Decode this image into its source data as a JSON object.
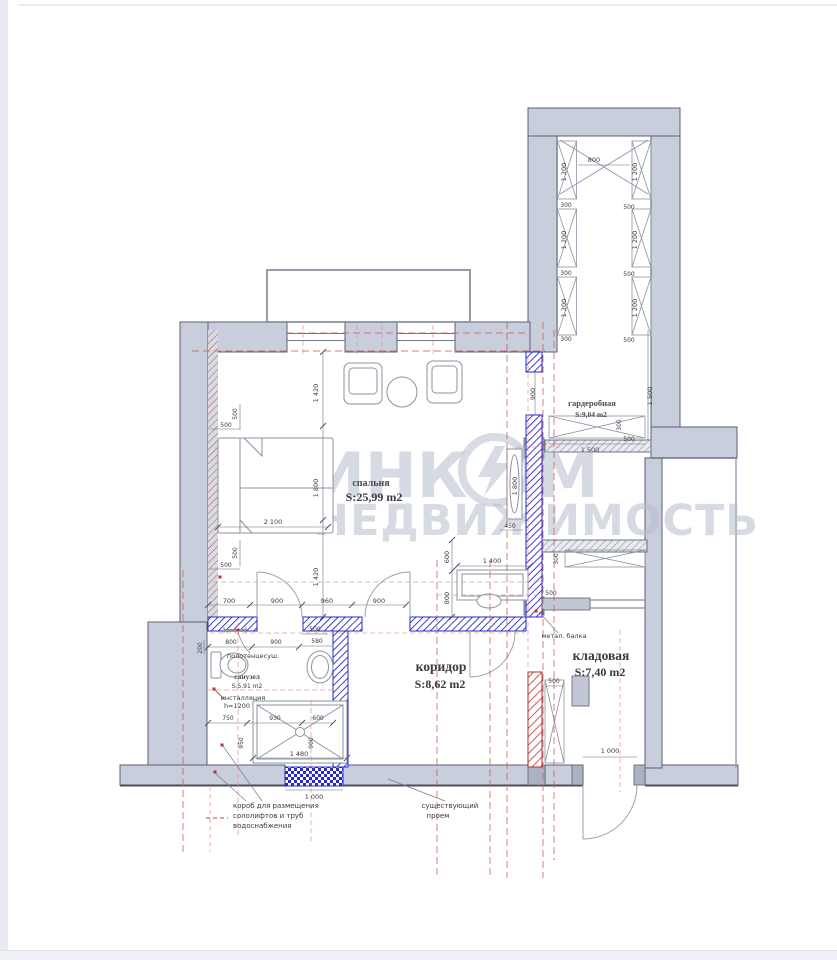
{
  "document": {
    "type": "apartment-floor-plan",
    "language": "ru"
  },
  "watermark": {
    "brand": "ИНКОМ",
    "brand_left": "ИНК",
    "brand_right": "М",
    "subtitle": "НЕДВИЖИМОСТЬ",
    "color": "#b6bdcd"
  },
  "rooms": {
    "bedroom": {
      "name": "спальня",
      "area": "S:25,99 m2"
    },
    "wardrobe": {
      "name": "гардеробная",
      "area": "S:9,04 m2"
    },
    "corridor": {
      "name": "коридор",
      "area": "S:8,62 m2"
    },
    "storage": {
      "name": "кладовая",
      "area": "S:7,40 m2"
    },
    "bathroom": {
      "name": "санузел",
      "area": "S:5,91 m2"
    }
  },
  "annotations": {
    "towel_dryer": "полотенцесуш.",
    "installation": "инсталляция",
    "installation_h": "h=1200",
    "metal_beam": "метал. балка",
    "existing_opening_1": "существующий",
    "existing_opening_2": "проем",
    "duct_1": "короб для размещения",
    "duct_2": "сололифтов и труб",
    "duct_3": "водоснабжения"
  },
  "dims": [
    "800",
    "1 200",
    "300",
    "1 200",
    "300",
    "1 200",
    "300",
    "1 200",
    "500",
    "1 200",
    "500",
    "1 200",
    "500",
    "900",
    "1 500",
    "300",
    "500",
    "1 500",
    "1 420",
    "1 800",
    "1 420",
    "500",
    "500",
    "2 100",
    "500",
    "500",
    "600",
    "1 400",
    "800",
    "450",
    "1 800",
    "700",
    "900",
    "960",
    "900",
    "200",
    "800",
    "900",
    "500",
    "580",
    "750",
    "930",
    "600",
    "950",
    "900",
    "1 480",
    "1 000",
    "300",
    "500",
    "500",
    "1 000"
  ],
  "colors": {
    "wall_existing": "#c9cedc",
    "wall_new_blue": "#2828cc",
    "wall_demolish_red": "#c24545",
    "axis_red_dash": "#cf5b5b",
    "watermark": "#b6bdcd"
  }
}
